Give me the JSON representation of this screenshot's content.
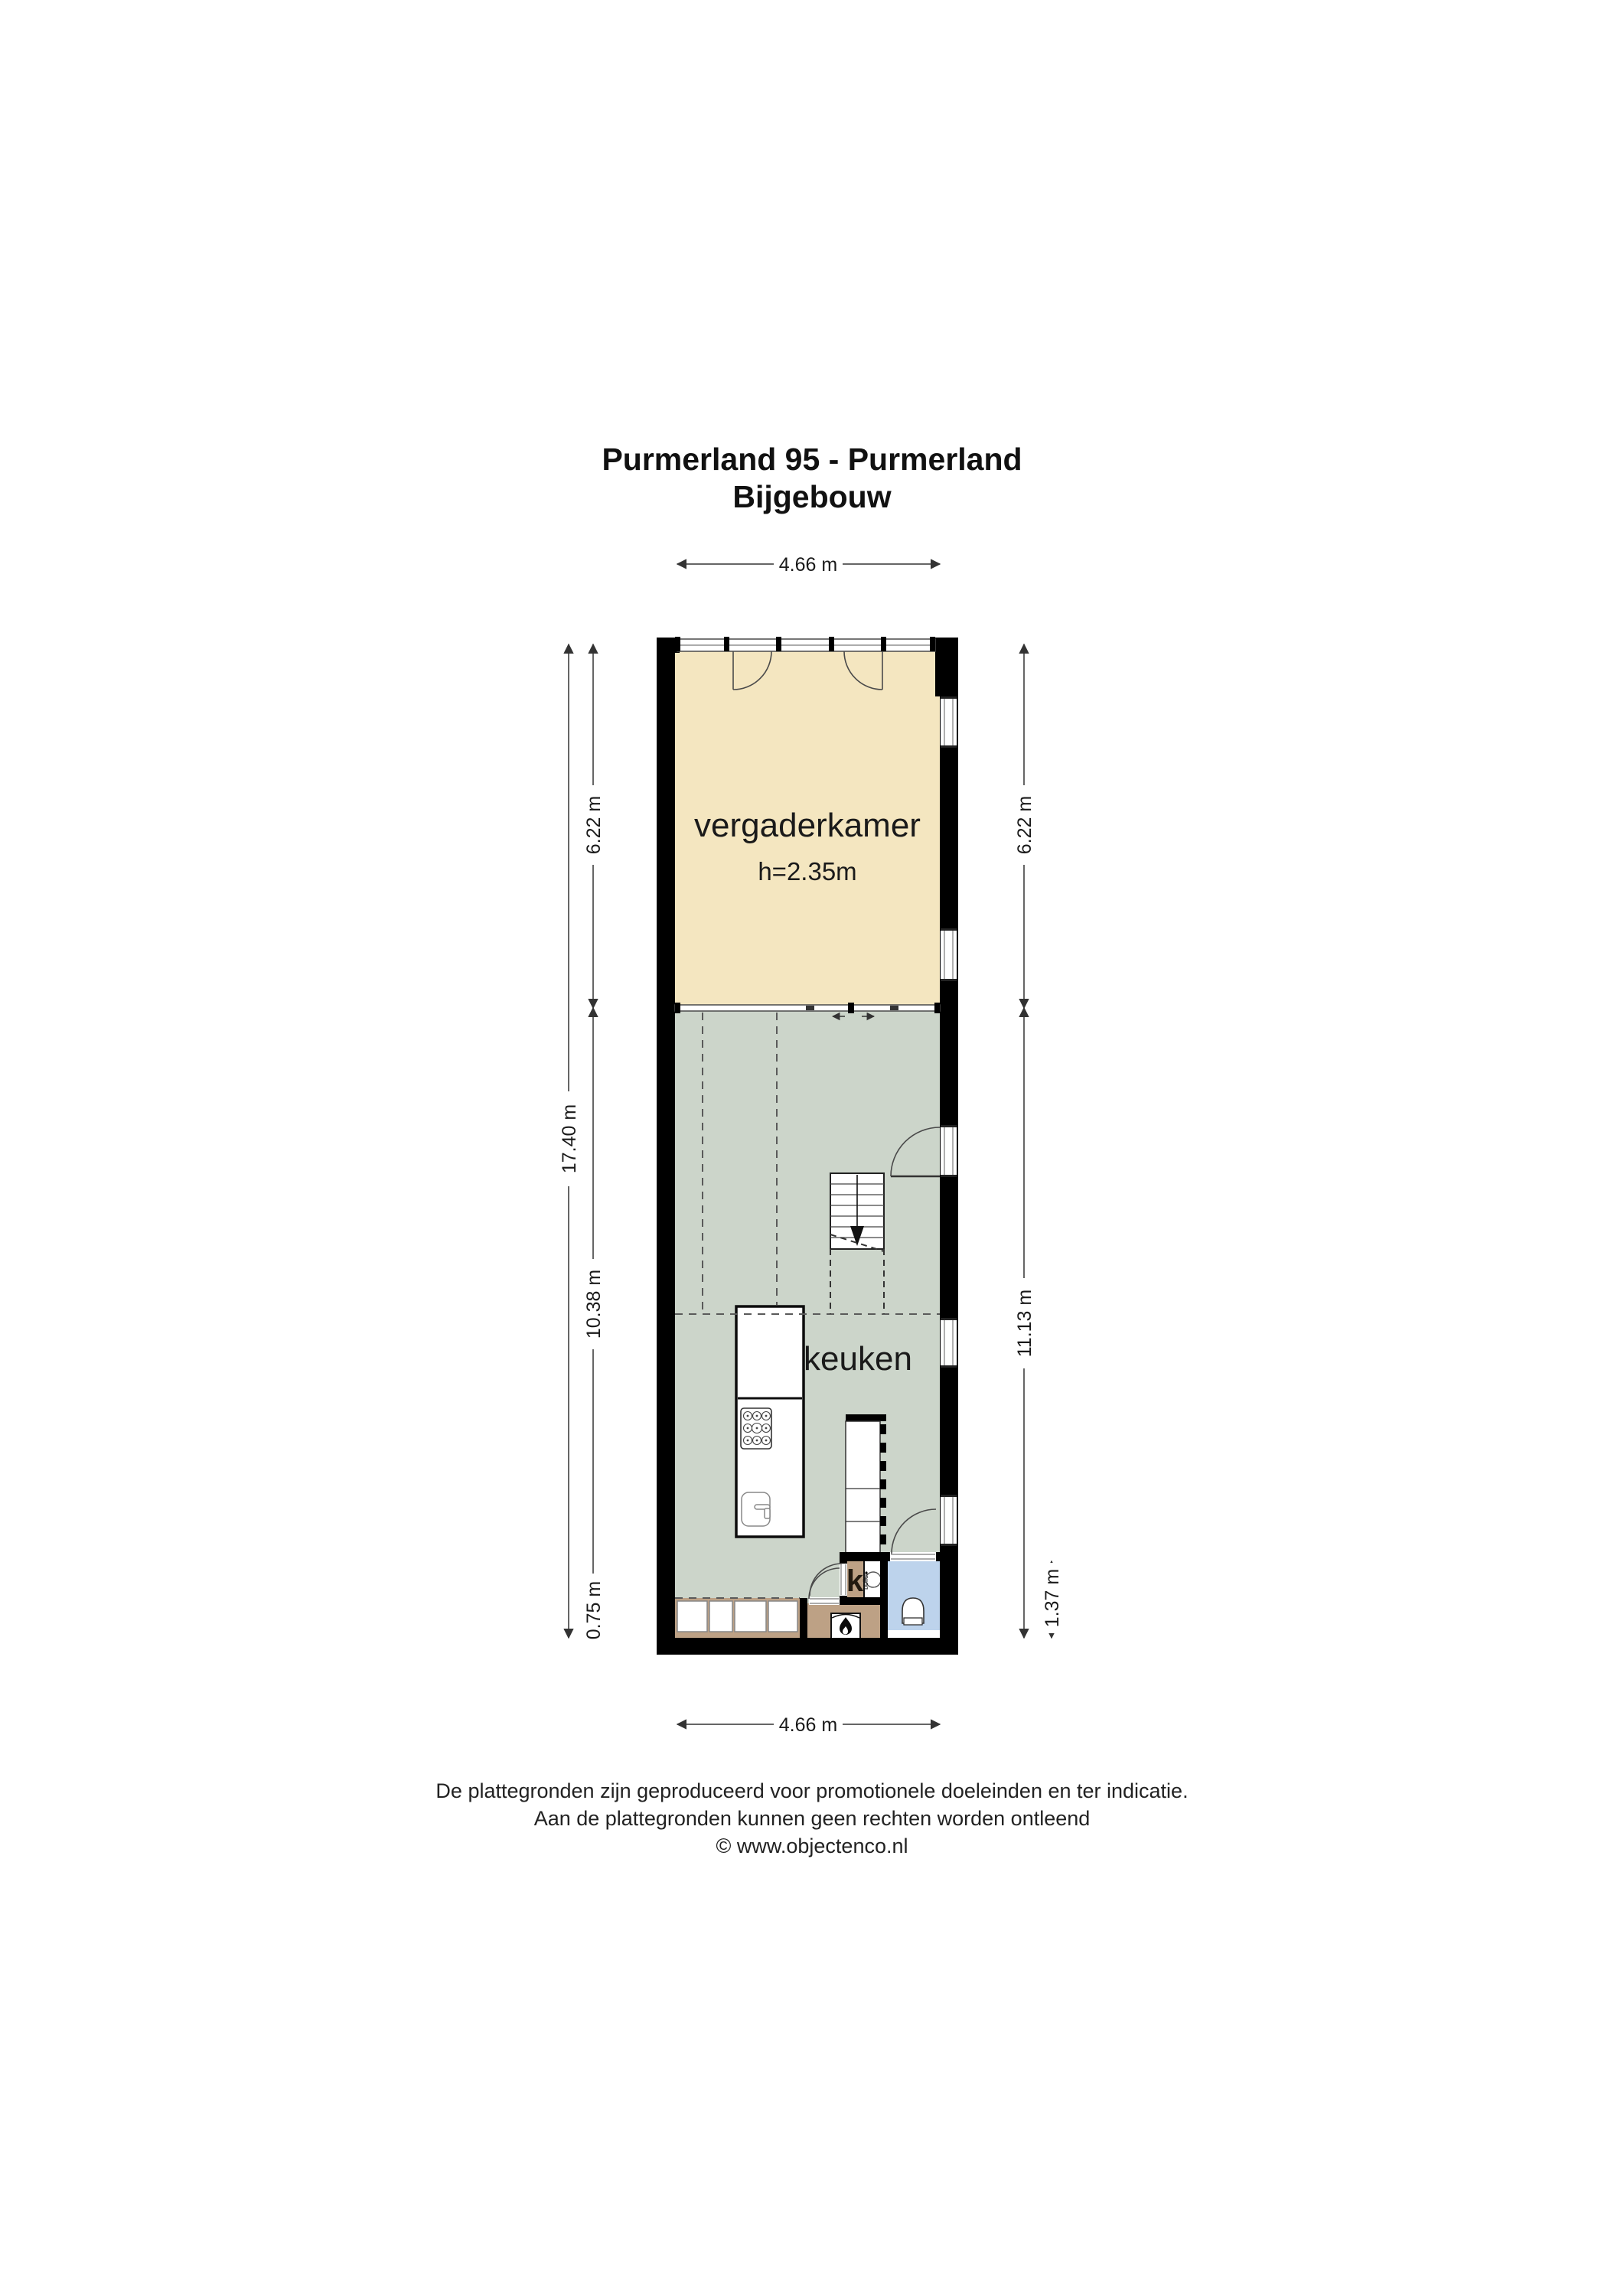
{
  "title": {
    "line1": "Purmerland 95 - Purmerland",
    "line2": "Bijgebouw"
  },
  "plan": {
    "rooms": {
      "vergaderkamer": {
        "label": "vergaderkamer",
        "ceiling_height": "h=2.35m"
      },
      "keuken": {
        "label": "keuken"
      },
      "kast": {
        "label": "k"
      },
      "boiler": {
        "label": "boiler"
      }
    },
    "dimensions": {
      "top_width": "4.66 m",
      "bottom_width": "4.66 m",
      "left_total_height": "17.40 m",
      "left_upper": "6.22 m",
      "left_middle": "10.38 m",
      "left_lower": "0.75 m",
      "right_upper": "6.22 m",
      "right_middle": "11.13 m",
      "right_lower": "1.37 m"
    }
  },
  "footer": {
    "line1": "De plattegronden zijn geproduceerd voor promotionele doeleinden en ter indicatie.",
    "line2": "Aan de plattegronden kunnen geen rechten worden ontleend",
    "line3": "© www.objectenco.nl"
  },
  "colors": {
    "wall": "#000000",
    "vergaderkamer": "#f4e6c0",
    "keuken": "#ccd5ca",
    "wood": "#bda185",
    "toilet": "#bdd3ec"
  }
}
